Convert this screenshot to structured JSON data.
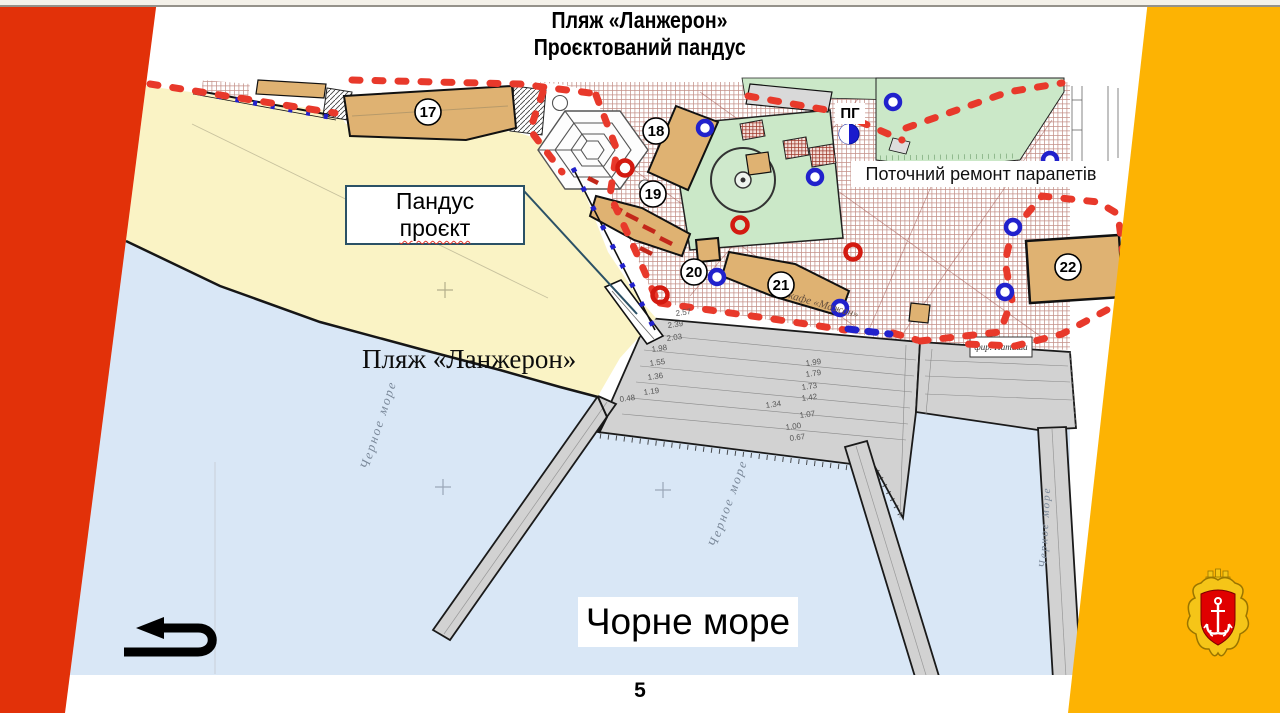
{
  "title": {
    "line1": "Пляж «Ланжерон»",
    "line2": "Проєктований пандус"
  },
  "footer": {
    "page_number": "5"
  },
  "annotations": {
    "ramp_line1": "Пандус",
    "ramp_line2": "проєкт",
    "beach_label": "Пляж «Ланжерон»",
    "parapet_note": "Поточний ремонт парапетів",
    "sea_label": "Чорне море",
    "hydrant_label": "ПГ",
    "sea_script": "Черное море",
    "cafe_script": "кафе «Мажан»",
    "firm_script": "фир. Наташа"
  },
  "map": {
    "buildings": [
      {
        "num": "17"
      },
      {
        "num": "18"
      },
      {
        "num": "19"
      },
      {
        "num": "20"
      },
      {
        "num": "21"
      },
      {
        "num": "22"
      }
    ],
    "elevations": [
      "2.57",
      "2.39",
      "2.03",
      "1.98",
      "1.55",
      "1.36",
      "1.19",
      "1.99",
      "1.79",
      "1.73",
      "1.42",
      "1.34",
      "1.07",
      "1.00",
      "0.67",
      "0.48"
    ]
  },
  "colors": {
    "band_red": "#E23109",
    "band_orange": "#FDB303",
    "sea": "#D9E7F6",
    "beach": "#FAF3C5",
    "platform_grey": "#D2D2D2",
    "building_tan": "#DFB272",
    "green": "#CBE8C8",
    "crosshatch": "#B06A60",
    "boundary_red": "#E8392B",
    "marker_blue": "#2121CC",
    "marker_red": "#D31A10",
    "ramp_box_border": "#2B5166"
  }
}
